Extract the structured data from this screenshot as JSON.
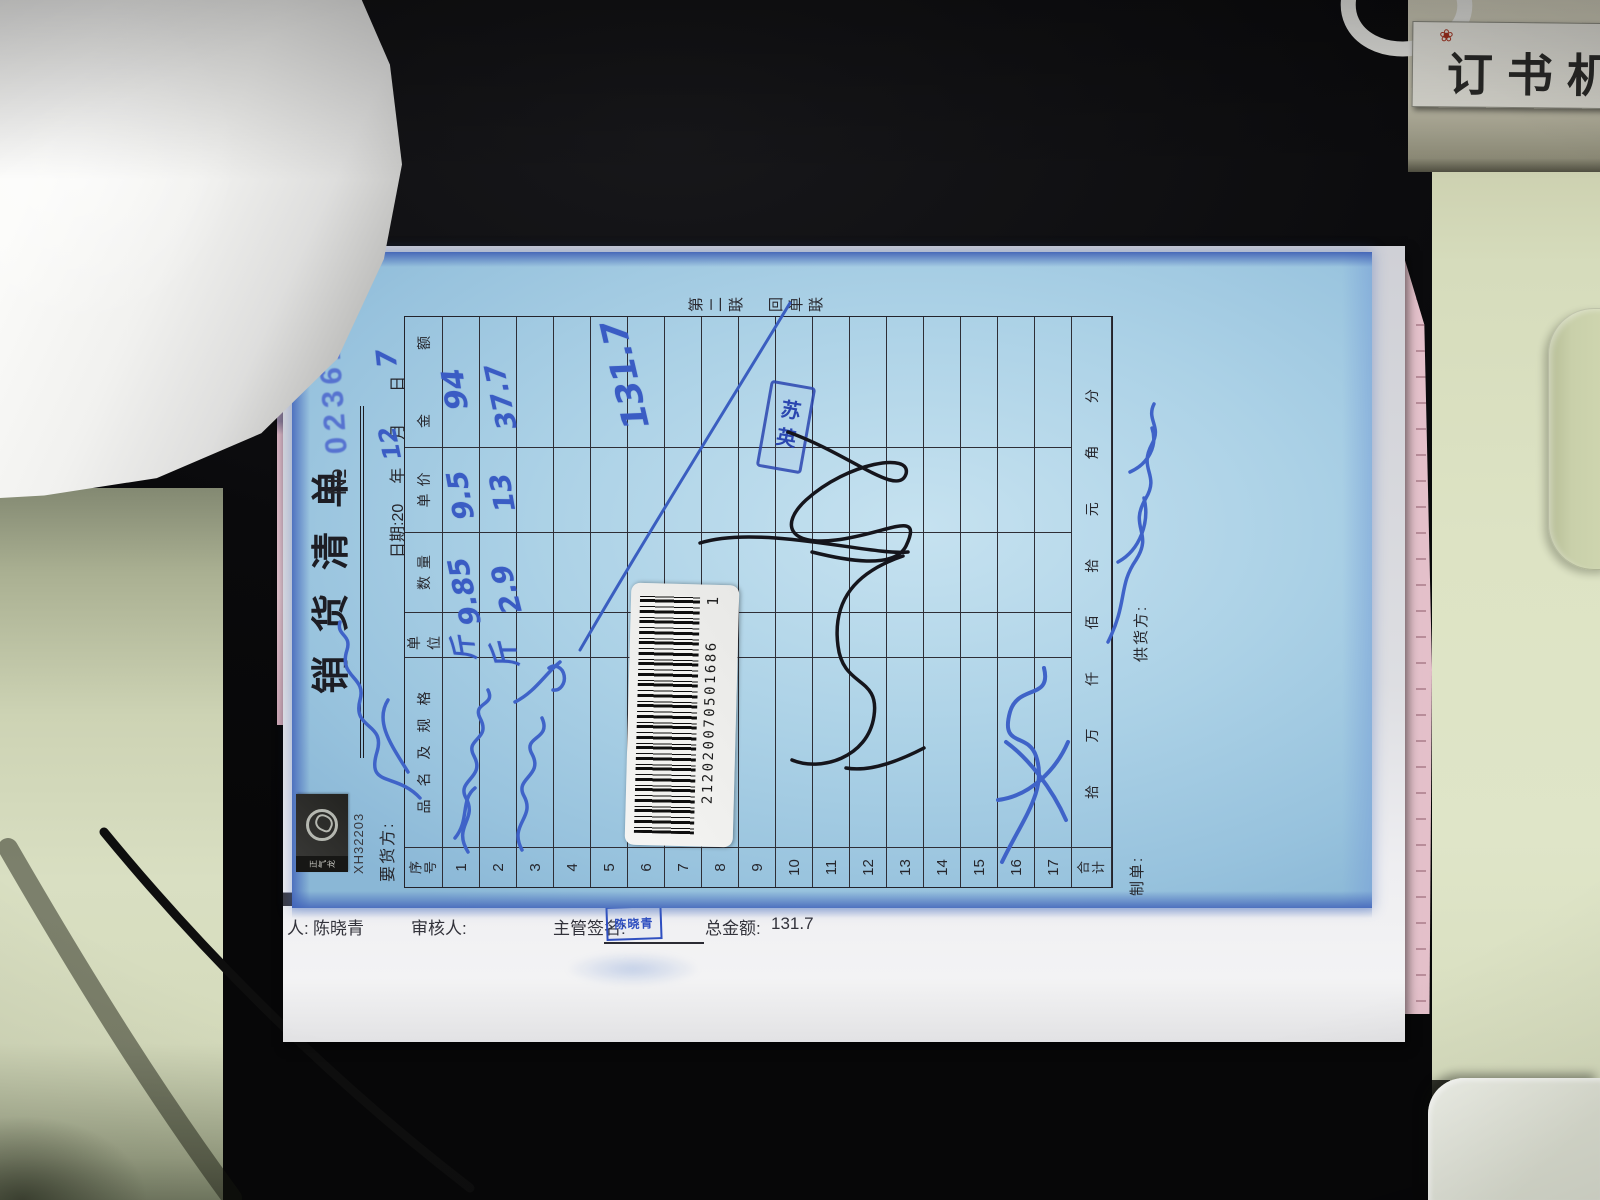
{
  "scene": {
    "stapler_label": "订书机",
    "stapler_mark_icon": "red-flower-mark"
  },
  "form": {
    "title": "销货清单",
    "copy_label": "第二联　回单联",
    "brand_code": "XH32203",
    "logo_text": "正气龙",
    "serial_prefix": "№",
    "serial_number": "023617",
    "buyer_label": "要货方:",
    "date": {
      "prefix": "日期:20",
      "year_handwritten": "12",
      "year_suffix": "年",
      "month_handwritten": "7",
      "month_suffix": "月",
      "day_suffix": "日"
    },
    "table": {
      "headers": {
        "no": "序号",
        "name": "品名及规格",
        "unit": "单位",
        "qty": "数量",
        "price": "单价",
        "amount": "金 额"
      },
      "row_labels": [
        "1",
        "2",
        "3",
        "4",
        "5",
        "6",
        "7",
        "8",
        "9",
        "10",
        "11",
        "12",
        "13",
        "14",
        "15",
        "16",
        "17"
      ],
      "entries": [
        {
          "row": "1",
          "unit": "斤",
          "qty": "9.85",
          "price": "9.5",
          "amount": "94"
        },
        {
          "row": "2",
          "unit": "斤",
          "qty": "2.9",
          "price": "13",
          "amount": "37.7"
        }
      ],
      "crossout_total": "131.7",
      "total_label": "合计",
      "digit_columns": [
        "拾",
        "万",
        "仟",
        "佰",
        "拾",
        "元",
        "角",
        "分"
      ]
    },
    "footer": {
      "maker_label": "制单:",
      "supplier_label": "供货方:"
    },
    "stamp": {
      "text": "苏英"
    },
    "barcode": {
      "number": "212020070501686",
      "suffix": "1"
    }
  },
  "under_sheet": {
    "sliver_text": "金额",
    "handler_label": "人:",
    "handler_value": "陈晓青",
    "reviewer_label": "审核人:",
    "signer_label": "主管签名:",
    "signer_stamp": "陈晓青",
    "total_label": "总金额:",
    "total_value": "131.7"
  },
  "colors": {
    "form_paper_blue": "#abd1e6",
    "ink_blue": "#3a5cc4",
    "stamp_blue": "#2b47b0",
    "desk_green": "#dde3c4"
  }
}
